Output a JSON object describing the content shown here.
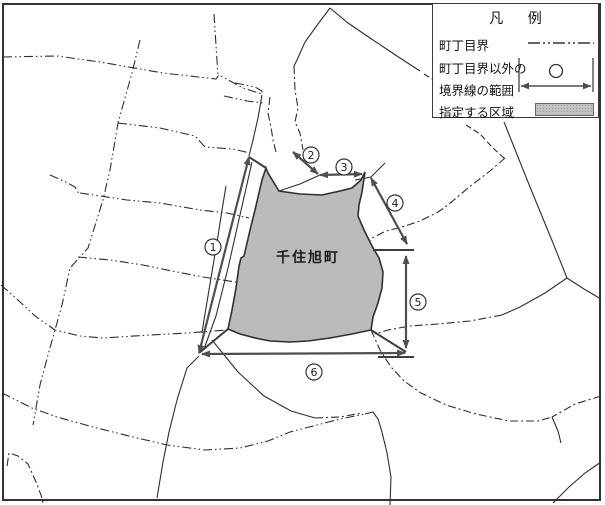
{
  "legend": {
    "title": "凡 例",
    "rows": [
      {
        "label": "町丁目界",
        "symbol": "chome-boundary-dashdot-line"
      },
      {
        "label_line1": "町丁目界以外の",
        "label_line2": "境界線の範囲",
        "symbol": "range-arrow-with-circle"
      },
      {
        "label": "指定する区域",
        "symbol": "gray-area-swatch"
      }
    ]
  },
  "map": {
    "area_label": "千住旭町",
    "markers": [
      {
        "number": "1",
        "x": 213,
        "y": 247
      },
      {
        "number": "2",
        "x": 311,
        "y": 155
      },
      {
        "number": "3",
        "x": 344,
        "y": 167
      },
      {
        "number": "4",
        "x": 395,
        "y": 203
      },
      {
        "number": "5",
        "x": 418,
        "y": 302
      },
      {
        "number": "6",
        "x": 314,
        "y": 372
      }
    ],
    "colors": {
      "area_fill": "#bcbcbc",
      "line": "#2e2e2e",
      "arrow": "#4f4f4f"
    }
  }
}
